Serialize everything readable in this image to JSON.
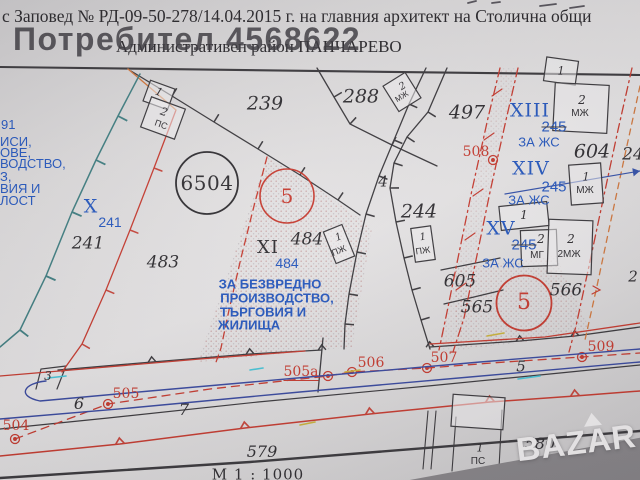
{
  "header": {
    "top_line": "с Заповед № РД-09-50-278/14.04.2015 г. на главния архитект на Столична общи",
    "district_line": "Административен район ПАНЧАРЕВО",
    "user_watermark": "Потребител 4568622"
  },
  "watermark": {
    "brand": "BAZAR"
  },
  "colors": {
    "black_print": "#2e2c30",
    "blue_print": "#2456bd",
    "red_print": "#c5392e",
    "road_blue": "#37479e",
    "teal_line": "#3f7d80"
  },
  "map": {
    "scale": "М 1 : 1000",
    "labels": [
      {
        "t": "239"
      },
      {
        "t": "288"
      },
      {
        "t": "497"
      },
      {
        "t": "604"
      },
      {
        "t": "24"
      },
      {
        "t": "XIII"
      },
      {
        "t": "245"
      },
      {
        "t": "ЗА ЖС"
      },
      {
        "t": "XIV"
      },
      {
        "t": "245"
      },
      {
        "t": "ЗА ЖС"
      },
      {
        "t": "508"
      },
      {
        "t": "XV"
      },
      {
        "t": "245"
      },
      {
        "t": "ЗА ЖС"
      },
      {
        "t": "605"
      },
      {
        "t": "565"
      },
      {
        "t": "566"
      },
      {
        "t": "5"
      },
      {
        "t": "2"
      },
      {
        "t": "6504"
      },
      {
        "t": "5"
      },
      {
        "t": "X"
      },
      {
        "t": "241"
      },
      {
        "t": "241"
      },
      {
        "t": "483"
      },
      {
        "t": "XI"
      },
      {
        "t": "484"
      },
      {
        "t": "484"
      },
      {
        "t": "ЗА БЕЗВРЕДНО"
      },
      {
        "t": "ПРОИЗВОДСТВО,"
      },
      {
        "t": "ТЪРГОВИЯ И"
      },
      {
        "t": "ЖИЛИЩА"
      },
      {
        "t": "244"
      },
      {
        "t": "4"
      },
      {
        "t": "3"
      },
      {
        "t": "6"
      },
      {
        "t": "7"
      },
      {
        "t": "504"
      },
      {
        "t": "505"
      },
      {
        "t": "505а"
      },
      {
        "t": "506"
      },
      {
        "t": "507"
      },
      {
        "t": "509"
      },
      {
        "t": "5"
      },
      {
        "t": "579"
      },
      {
        "t": "580"
      },
      {
        "t": "М 1 : 1000"
      },
      {
        "t": "91"
      },
      {
        "t": "ИСИ,"
      },
      {
        "t": "ОВЕ,"
      },
      {
        "t": "ВОДСТВО,"
      },
      {
        "t": "З,"
      },
      {
        "t": "ВИЯ И"
      },
      {
        "t": "ЛОСТ"
      }
    ],
    "bld": [
      {
        "t": "1"
      },
      {
        "t": "2"
      },
      {
        "t": "ПС"
      },
      {
        "t": "2"
      },
      {
        "t": "МЖ"
      },
      {
        "t": "1"
      },
      {
        "t": "2"
      },
      {
        "t": "МЖ"
      },
      {
        "t": "1"
      },
      {
        "t": "МЖ"
      },
      {
        "t": "1"
      },
      {
        "t": "2"
      },
      {
        "t": "МГ"
      },
      {
        "t": "2"
      },
      {
        "t": "2МЖ"
      },
      {
        "t": "1"
      },
      {
        "t": "ПЖ"
      },
      {
        "t": "1"
      },
      {
        "t": "ПЖ"
      },
      {
        "t": "1"
      },
      {
        "t": "ПС"
      }
    ]
  }
}
